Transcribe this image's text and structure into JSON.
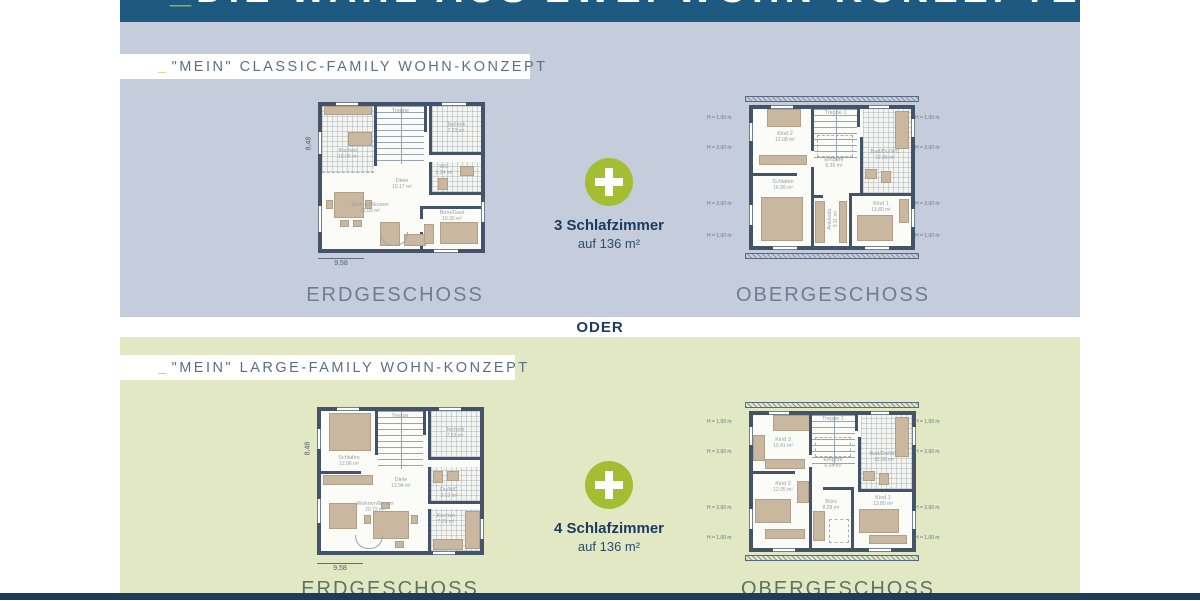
{
  "header": {
    "underscore": "_",
    "title": "DIE WAHL AUS ZWEI WOHN-KONZEPTEN"
  },
  "divider_label": "ODER",
  "colors": {
    "header_blue": "#1e5a7f",
    "section_classic_bg": "#c5cddc",
    "section_large_bg": "#e2e7c4",
    "accent_green": "#a4bd33",
    "navy_text": "#1b3a5f",
    "underscore_yellow": "#dfb94a",
    "underscore_green": "#8fb43d",
    "wall_color": "#42536a"
  },
  "sections": [
    {
      "theme": "classic",
      "badge_underscore": "_",
      "badge_label": "\"MEIN\" CLASSIC-FAMILY WOHN-KONZEPT",
      "plus_headline": "3 Schlafzimmer",
      "plus_subline": "auf 136 m²",
      "floors": [
        {
          "title": "ERDGESCHOSS",
          "dim_bottom": "9,58",
          "dim_left": "8,48",
          "rooms": {
            "kochen": {
              "name": "Kochen",
              "area": "12.06 m²"
            },
            "treppe": {
              "name": "Treppe",
              "area": ""
            },
            "technik": {
              "name": "Technik",
              "area": "7.23 m²"
            },
            "diele": {
              "name": "Diele",
              "area": "10.17 m²"
            },
            "wc": {
              "name": "WC",
              "area": "1.34 m²"
            },
            "wohnen": {
              "name": "Wohnen/Essen",
              "area": "21.09 m²"
            },
            "buero_gast": {
              "name": "Büro/Gast",
              "area": "10.30 m²"
            }
          }
        },
        {
          "title": "OBERGESCHOSS",
          "dim_side_top": "H = 1,00 m",
          "dim_side_mid": "H = 2,00 m",
          "rooms": {
            "kind2": {
              "name": "Kind 2",
              "area": "12.08 m²"
            },
            "treppe": {
              "name": "Treppe 1",
              "area": ""
            },
            "bad": {
              "name": "Bad/Du/WC",
              "area": "12.06 m²"
            },
            "empore": {
              "name": "Empore",
              "area": "5.36 m²"
            },
            "schlafen": {
              "name": "Schlafen",
              "area": "16.99 m²"
            },
            "ankleide": {
              "name": "Ankleide",
              "area": "5.11 m²"
            },
            "kind1": {
              "name": "Kind 1",
              "area": "13.80 m²"
            }
          }
        }
      ]
    },
    {
      "theme": "large",
      "badge_underscore": "_",
      "badge_label": "\"MEIN\" LARGE-FAMILY WOHN-KONZEPT",
      "plus_headline": "4 Schlafzimmer",
      "plus_subline": "auf 136 m²",
      "floors": [
        {
          "title": "ERDGESCHOSS",
          "dim_bottom": "9,58",
          "dim_left": "8,48",
          "rooms": {
            "schlafen": {
              "name": "Schlafen",
              "area": "12.06 m²"
            },
            "treppe": {
              "name": "Treppe",
              "area": ""
            },
            "technik": {
              "name": "Technik",
              "area": "7.23 m²"
            },
            "diele": {
              "name": "Diele",
              "area": "13.94 m²"
            },
            "duwc": {
              "name": "Du/WC",
              "area": "3.12 m²"
            },
            "wohnen": {
              "name": "Wohnen/Essen",
              "area": "20.72 m²"
            },
            "kochen": {
              "name": "Kochen",
              "area": "7.29 m²"
            }
          }
        },
        {
          "title": "OBERGESCHOSS",
          "dim_side_top": "H = 1,00 m",
          "dim_side_mid": "H = 2,00 m",
          "rooms": {
            "kind3": {
              "name": "Kind 3",
              "area": "10.41 m²"
            },
            "treppe": {
              "name": "Treppe 1",
              "area": ""
            },
            "bad": {
              "name": "Bad/Du/WC",
              "area": "12.06 m²"
            },
            "empore": {
              "name": "Empore",
              "area": "6.94 m²"
            },
            "kind2": {
              "name": "Kind 2",
              "area": "12.05 m²"
            },
            "buero": {
              "name": "Büro",
              "area": "8.28 m²"
            },
            "kind1": {
              "name": "Kind 1",
              "area": "13.80 m²"
            }
          }
        }
      ]
    }
  ]
}
